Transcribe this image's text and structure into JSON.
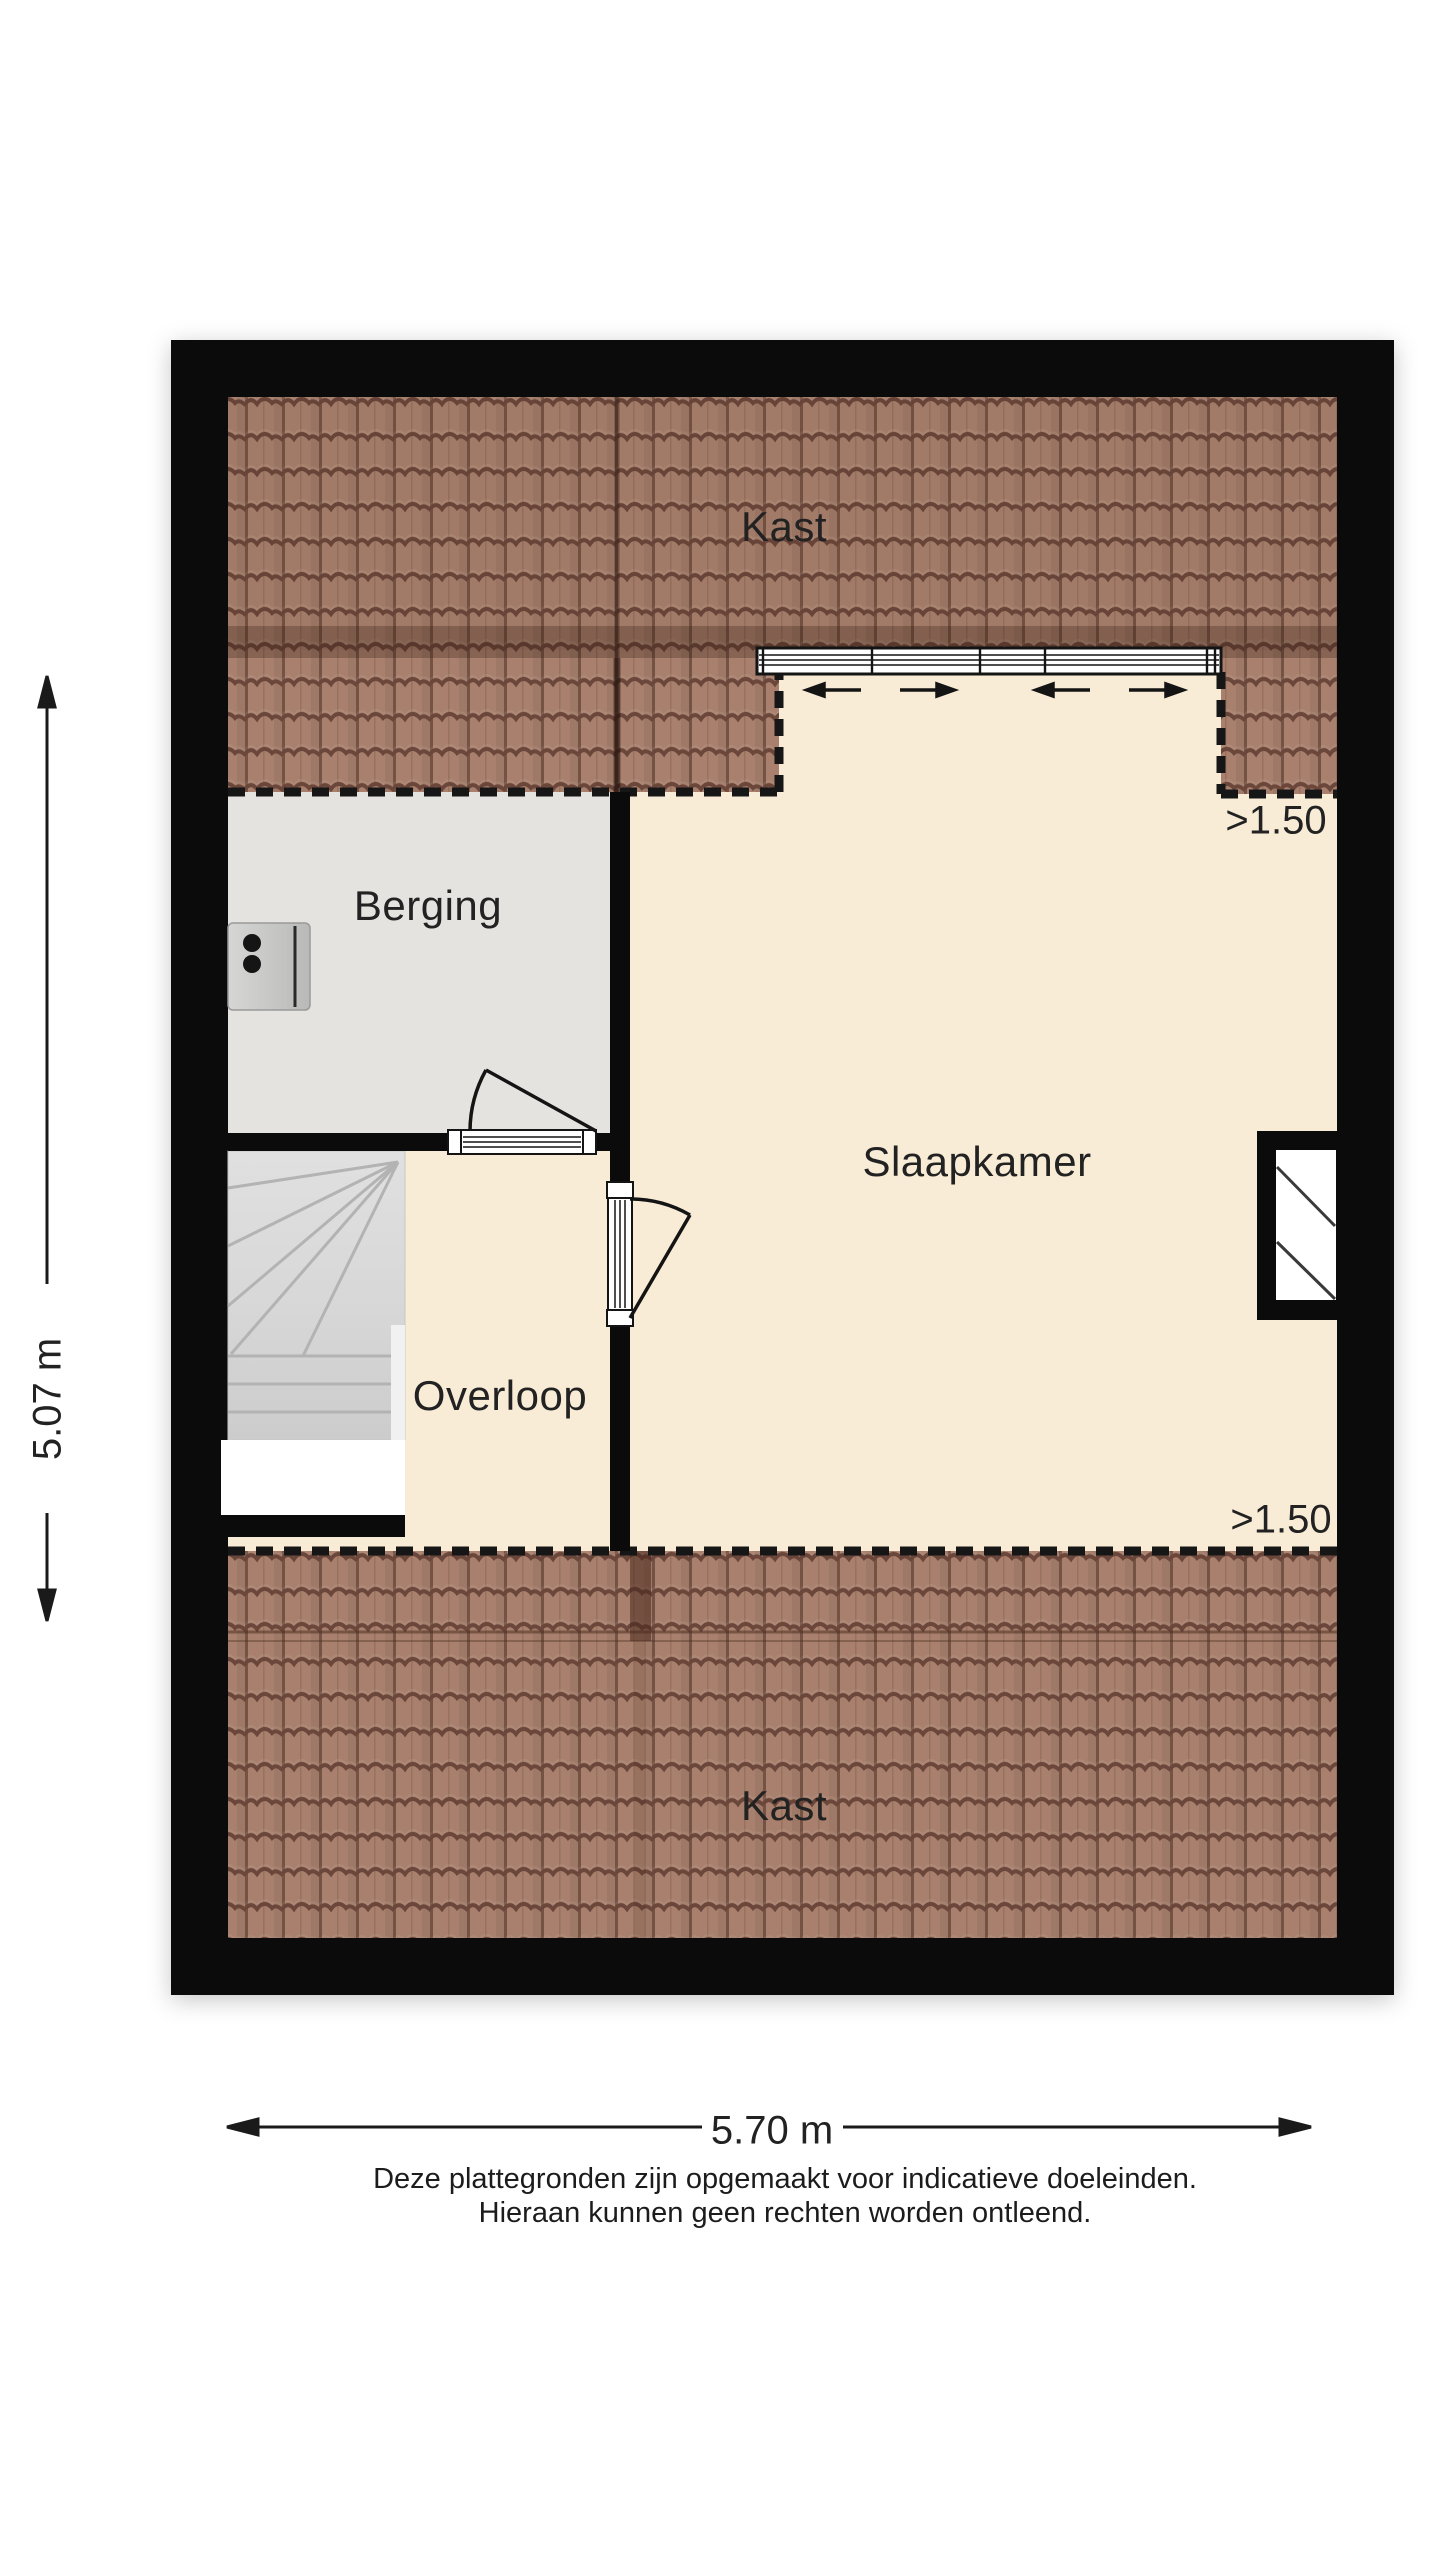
{
  "floorplan": {
    "title": "attic floor plan",
    "rooms": {
      "kast_top": "Kast",
      "berging": "Berging",
      "slaapkamer": "Slaapkamer",
      "overloop": "Overloop",
      "kast_bottom": "Kast"
    },
    "annotations": {
      "height_clearance_top": ">1.50",
      "height_clearance_bottom": ">1.50"
    },
    "dimensions": {
      "width_label": "5.70 m",
      "height_label": "5.07 m"
    },
    "disclaimer": {
      "line1": "Deze plattegronden zijn opgemaakt voor indicatieve doeleinden.",
      "line2": "Hieraan kunnen geen rechten worden ontleend."
    },
    "icons": {
      "socket": "power-socket-icon",
      "roof_window": "roof-window-icon",
      "stairs": "stairs-icon",
      "door_swing": "door-swing-icon",
      "slide_arrows": "window-slide-arrows"
    },
    "colors": {
      "wall": "#0b0b0b",
      "floor_cream": "#f8ecd6",
      "floor_gray": "#e4e3df",
      "roof_tile": "#a8806d",
      "roof_wave": "#6b463a",
      "dash": "#161616",
      "text": "#222222"
    }
  }
}
